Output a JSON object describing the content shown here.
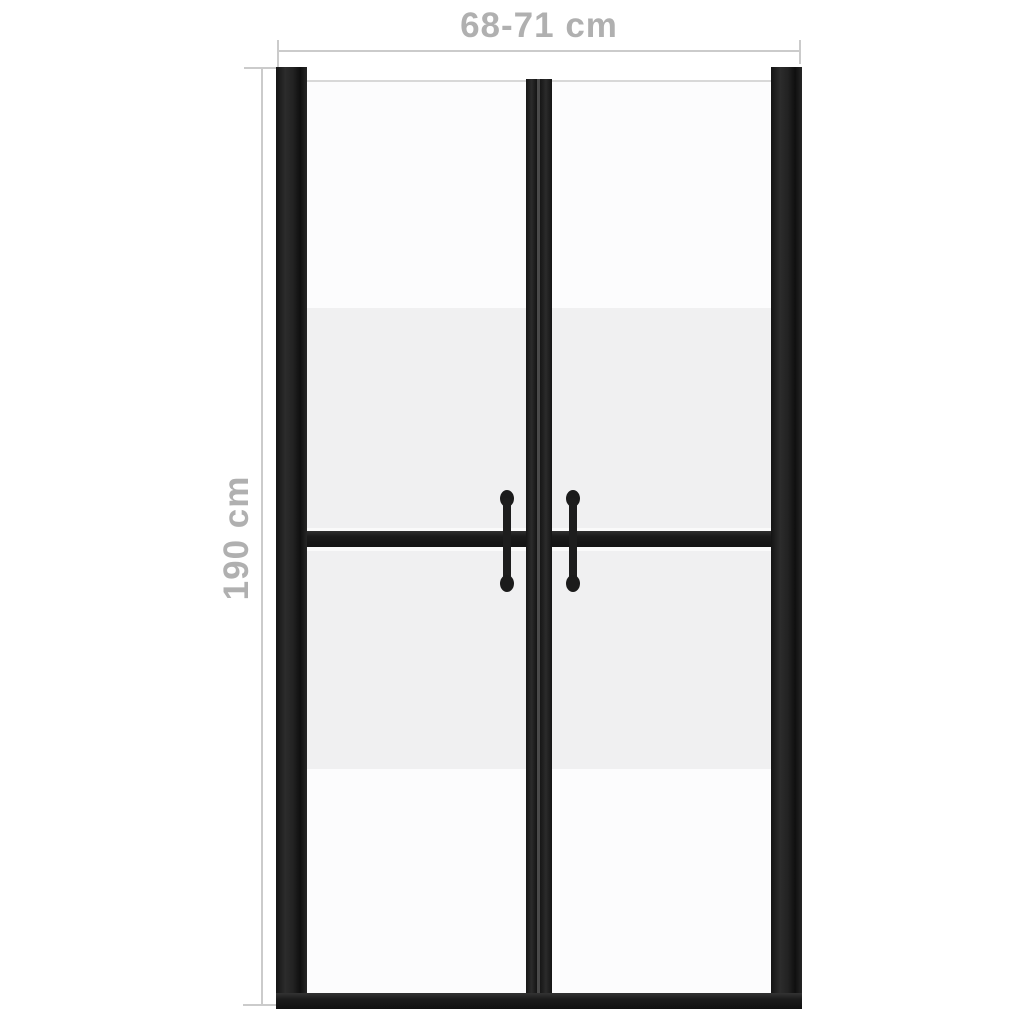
{
  "image": {
    "type": "product-dimension-diagram",
    "subject": "shower door, two panels, half-frosted safety glass, black aluminium frame",
    "background_color": "#ffffff"
  },
  "annotations": {
    "width_label": "68-71 cm",
    "height_label": "190 cm",
    "label_color": "#b0b0b0",
    "line_color": "#cbcbcb"
  },
  "door": {
    "panels": 2,
    "handles": 2,
    "frame_color": "#1c1c1c",
    "glass_clear_color": "#fcfcfd",
    "glass_frosted_color": "#f0f0f1",
    "glass_top_edge_color": "#d8d8d8"
  }
}
